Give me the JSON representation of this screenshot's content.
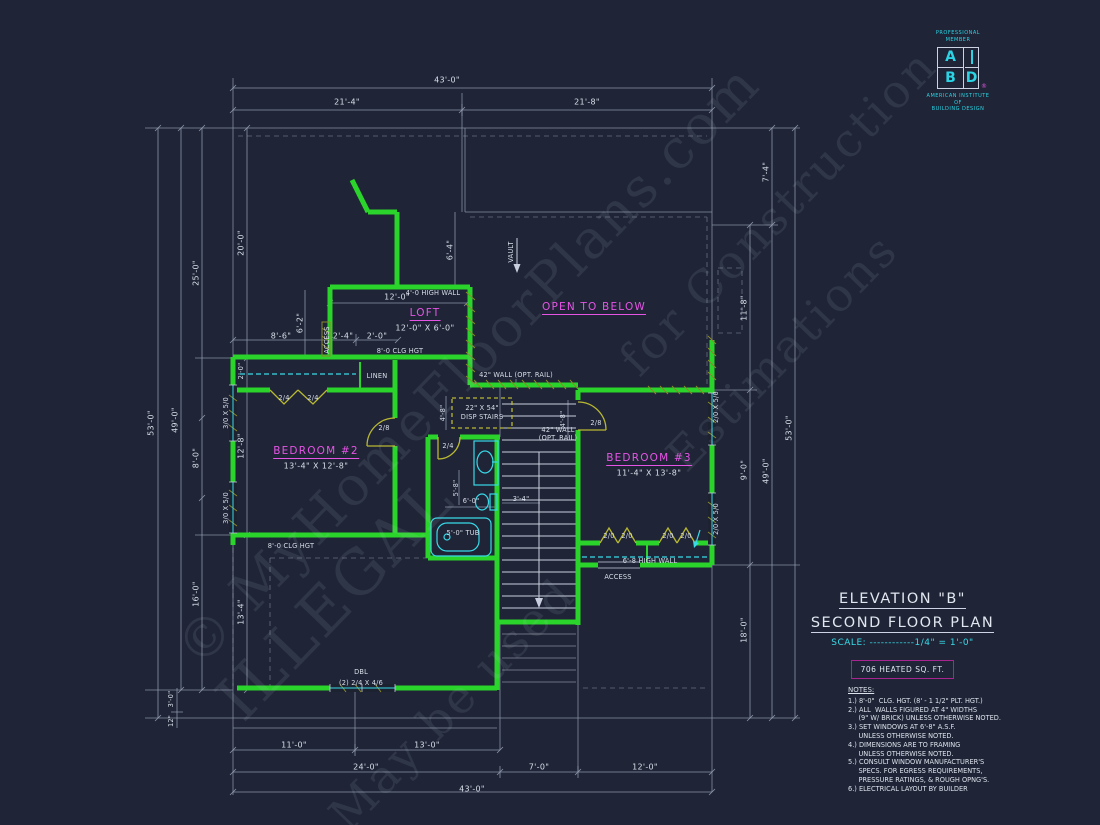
{
  "colors": {
    "background": "#1f2536",
    "wall_green": "#2bd42b",
    "fixture_cyan": "#38d9e8",
    "label_magenta": "#e654e6",
    "door_olive": "#b9b832",
    "line_gray": "#97a0b6",
    "heated_box_border": "#a8258f",
    "logo_cyan": "#2bd3e4"
  },
  "title_block": {
    "line1": "ELEVATION \"B\"",
    "line2": "SECOND FLOOR PLAN",
    "scale": "SCALE: ------------1/4\" = 1'-0\"",
    "heated": "706 HEATED SQ. FT."
  },
  "logo": {
    "top1": "PROFESSIONAL",
    "top2": "MEMBER",
    "a": "A",
    "b": "B",
    "d": "D",
    "reg": "®",
    "org1": "AMERICAN INSTITUTE",
    "org2": "OF",
    "org3": "BUILDING DESIGN"
  },
  "notes": {
    "lines": [
      "NOTES:",
      "1.) 8'-0\"  CLG. HGT. (8' - 1 1/2\" PLT. HGT.)",
      "2.) ALL  WALLS FIGURED AT 4\" WIDTHS",
      "     (9\" W/ BRICK) UNLESS OTHERWISE NOTED.",
      "3.) SET WINDOWS AT 6'-8\" A.S.F.",
      "     UNLESS OTHERWISE NOTED.",
      "4.) DIMENSIONS ARE TO FRAMING",
      "     UNLESS OTHERWISE NOTED.",
      "5.) CONSULT WINDOW MANUFACTURER'S",
      "     SPECS. FOR EGRESS REQUIREMENTS,",
      "     PRESSURE RATINGS, & ROUGH OPNG'S.",
      "6.) ELECTRICAL LAYOUT BY BUILDER"
    ]
  },
  "watermarks": [
    {
      "t": "© MyHomeFloorPlans.com",
      "x": 468,
      "y": 365,
      "size": 54,
      "n": "watermark-site"
    },
    {
      "t": "ILLEGAL",
      "x": 335,
      "y": 598,
      "size": 62,
      "n": "watermark-illegal"
    },
    {
      "t": "for Construction",
      "x": 778,
      "y": 212,
      "size": 46,
      "n": "watermark-construction"
    },
    {
      "t": "May be used",
      "x": 452,
      "y": 704,
      "size": 46,
      "n": "watermark-may-be-used"
    },
    {
      "t": "Estimations",
      "x": 782,
      "y": 352,
      "size": 46,
      "n": "watermark-estimations"
    }
  ],
  "plan": {
    "labels": [
      {
        "t": "43'-0\"",
        "x": 447,
        "y": 80,
        "r": 0,
        "s": "dim"
      },
      {
        "t": "21'-4\"",
        "x": 347,
        "y": 102,
        "r": 0,
        "s": "dim"
      },
      {
        "t": "21'-8\"",
        "x": 587,
        "y": 102,
        "r": 0,
        "s": "dim"
      },
      {
        "t": "11'-0\"",
        "x": 294,
        "y": 745,
        "r": 0,
        "s": "dim"
      },
      {
        "t": "13'-0\"",
        "x": 427,
        "y": 745,
        "r": 0,
        "s": "dim"
      },
      {
        "t": "24'-0\"",
        "x": 366,
        "y": 767,
        "r": 0,
        "s": "dim"
      },
      {
        "t": "7'-0\"",
        "x": 539,
        "y": 767,
        "r": 0,
        "s": "dim"
      },
      {
        "t": "12'-0\"",
        "x": 645,
        "y": 767,
        "r": 0,
        "s": "dim"
      },
      {
        "t": "43'-0\"",
        "x": 472,
        "y": 789,
        "r": 0,
        "s": "dim"
      },
      {
        "t": "53'-0\"",
        "x": 151,
        "y": 423,
        "r": -90,
        "s": "dim"
      },
      {
        "t": "49'-0\"",
        "x": 175,
        "y": 420,
        "r": -90,
        "s": "dim"
      },
      {
        "t": "25'-0\"",
        "x": 196,
        "y": 273,
        "r": -90,
        "s": "dim"
      },
      {
        "t": "8'-0\"",
        "x": 196,
        "y": 458,
        "r": -90,
        "s": "dim"
      },
      {
        "t": "16'-0\"",
        "x": 196,
        "y": 594,
        "r": -90,
        "s": "dim"
      },
      {
        "t": "20'-0\"",
        "x": 241,
        "y": 243,
        "r": -90,
        "s": "dim"
      },
      {
        "t": "12'-8\"",
        "x": 241,
        "y": 446,
        "r": -90,
        "s": "dim"
      },
      {
        "t": "13'-4\"",
        "x": 241,
        "y": 612,
        "r": -90,
        "s": "dim"
      },
      {
        "t": "3'-0\"",
        "x": 171,
        "y": 699,
        "r": -90,
        "s": "tiny"
      },
      {
        "t": "12\"",
        "x": 171,
        "y": 721,
        "r": -90,
        "s": "tiny"
      },
      {
        "t": "7'-4\"",
        "x": 766,
        "y": 172,
        "r": -90,
        "s": "dim"
      },
      {
        "t": "11'-8\"",
        "x": 744,
        "y": 308,
        "r": -90,
        "s": "dim"
      },
      {
        "t": "9'-0\"",
        "x": 744,
        "y": 470,
        "r": -90,
        "s": "dim"
      },
      {
        "t": "18'-0\"",
        "x": 744,
        "y": 630,
        "r": -90,
        "s": "dim"
      },
      {
        "t": "49'-0\"",
        "x": 766,
        "y": 471,
        "r": -90,
        "s": "dim"
      },
      {
        "t": "53'-0\"",
        "x": 789,
        "y": 428,
        "r": -90,
        "s": "dim"
      },
      {
        "t": "6'-4\"",
        "x": 450,
        "y": 250,
        "r": -90,
        "s": "dim"
      },
      {
        "t": "VAULT",
        "x": 511,
        "y": 252,
        "r": -90,
        "s": "tiny",
        "n": "vault-label"
      },
      {
        "t": "4'-0 HIGH WALL",
        "x": 433,
        "y": 293,
        "r": 0,
        "s": "tiny",
        "n": "high-wall-label"
      },
      {
        "t": "12'-0\"",
        "x": 397,
        "y": 297,
        "r": 0,
        "s": "dim"
      },
      {
        "t": "LOFT",
        "x": 425,
        "y": 314,
        "r": 0,
        "s": "room",
        "n": "loft-label"
      },
      {
        "t": "12'-0\" X 6'-0\"",
        "x": 425,
        "y": 328,
        "r": 0,
        "s": "roomsub"
      },
      {
        "t": "OPEN TO BELOW",
        "x": 594,
        "y": 308,
        "r": 0,
        "s": "room",
        "n": "open-to-below-label"
      },
      {
        "t": "6'-2\"",
        "x": 300,
        "y": 323,
        "r": -90,
        "s": "dim"
      },
      {
        "t": "8'-6\"",
        "x": 281,
        "y": 336,
        "r": 0,
        "s": "dim"
      },
      {
        "t": "2'-4\"",
        "x": 343,
        "y": 336,
        "r": 0,
        "s": "dim"
      },
      {
        "t": "2'-0\"",
        "x": 377,
        "y": 336,
        "r": 0,
        "s": "dim"
      },
      {
        "t": "ACCESS",
        "x": 327,
        "y": 340,
        "r": -90,
        "s": "tiny",
        "n": "access-label"
      },
      {
        "t": "8'-0 CLG HGT",
        "x": 400,
        "y": 351,
        "r": 0,
        "s": "tiny",
        "n": "clg-hgt-label"
      },
      {
        "t": "LINEN",
        "x": 377,
        "y": 376,
        "r": 0,
        "s": "tiny",
        "n": "linen-label"
      },
      {
        "t": "2/4",
        "x": 284,
        "y": 398,
        "r": 0,
        "s": "tiny"
      },
      {
        "t": "2/4",
        "x": 313,
        "y": 398,
        "r": 0,
        "s": "tiny"
      },
      {
        "t": "2'-0\"",
        "x": 241,
        "y": 371,
        "r": -90,
        "s": "tiny"
      },
      {
        "t": "3/0 X 5/0",
        "x": 226,
        "y": 413,
        "r": -90,
        "s": "tiny",
        "n": "window-label"
      },
      {
        "t": "3/0 X 5/0",
        "x": 226,
        "y": 508,
        "r": -90,
        "s": "tiny",
        "n": "window-label"
      },
      {
        "t": "BEDROOM #2",
        "x": 316,
        "y": 452,
        "r": 0,
        "s": "room",
        "n": "bedroom2-label"
      },
      {
        "t": "13'-4\" X 12'-8\"",
        "x": 316,
        "y": 466,
        "r": 0,
        "s": "roomsub"
      },
      {
        "t": "BEDROOM #3",
        "x": 649,
        "y": 459,
        "r": 0,
        "s": "room",
        "n": "bedroom3-label"
      },
      {
        "t": "11'-4\" X 13'-8\"",
        "x": 649,
        "y": 473,
        "r": 0,
        "s": "roomsub"
      },
      {
        "t": "42\" WALL (OPT. RAIL)",
        "x": 516,
        "y": 375,
        "r": 0,
        "s": "tiny",
        "n": "rail-wall-label"
      },
      {
        "t": "22\" X 54\"",
        "x": 482,
        "y": 408,
        "r": 0,
        "s": "tiny"
      },
      {
        "t": "DISP STAIRS",
        "x": 482,
        "y": 417,
        "r": 0,
        "s": "tiny",
        "n": "disp-stairs-label"
      },
      {
        "t": "4'-8\"",
        "x": 443,
        "y": 413,
        "r": -90,
        "s": "tiny"
      },
      {
        "t": "4'-8\"",
        "x": 563,
        "y": 419,
        "r": -90,
        "s": "tiny"
      },
      {
        "t": "2/4",
        "x": 448,
        "y": 446,
        "r": 0,
        "s": "tiny"
      },
      {
        "t": "5'-8\"",
        "x": 456,
        "y": 488,
        "r": -90,
        "s": "tiny"
      },
      {
        "t": "6'-0\"",
        "x": 471,
        "y": 501,
        "r": 0,
        "s": "tiny"
      },
      {
        "t": "5'-0\" TUB",
        "x": 463,
        "y": 533,
        "r": 0,
        "s": "tiny",
        "n": "tub-label"
      },
      {
        "t": "3'-4\"",
        "x": 521,
        "y": 499,
        "r": 0,
        "s": "tiny"
      },
      {
        "t": "42\" WALL",
        "x": 558,
        "y": 430,
        "r": 0,
        "s": "tiny"
      },
      {
        "t": "(OPT. RAIL)",
        "x": 558,
        "y": 438,
        "r": 0,
        "s": "tiny"
      },
      {
        "t": "2/8",
        "x": 384,
        "y": 428,
        "r": 0,
        "s": "tiny"
      },
      {
        "t": "2/8",
        "x": 596,
        "y": 423,
        "r": 0,
        "s": "tiny"
      },
      {
        "t": "2/0",
        "x": 609,
        "y": 536,
        "r": 0,
        "s": "tiny"
      },
      {
        "t": "2/0",
        "x": 627,
        "y": 536,
        "r": 0,
        "s": "tiny"
      },
      {
        "t": "2/0",
        "x": 668,
        "y": 536,
        "r": 0,
        "s": "tiny"
      },
      {
        "t": "2/0",
        "x": 686,
        "y": 536,
        "r": 0,
        "s": "tiny"
      },
      {
        "t": "6'-8 HIGH WALL",
        "x": 650,
        "y": 561,
        "r": 0,
        "s": "tiny",
        "n": "high-wall-label-2"
      },
      {
        "t": "ACCESS",
        "x": 618,
        "y": 577,
        "r": 0,
        "s": "tiny",
        "n": "access-label-2"
      },
      {
        "t": "2/0 X 5/0",
        "x": 716,
        "y": 407,
        "r": -90,
        "s": "tiny",
        "n": "window-label"
      },
      {
        "t": "2/0 X 5/0",
        "x": 716,
        "y": 519,
        "r": -90,
        "s": "tiny",
        "n": "window-label"
      },
      {
        "t": "8'-0 CLG HGT",
        "x": 291,
        "y": 546,
        "r": 0,
        "s": "tiny",
        "n": "clg-hgt-label-2"
      },
      {
        "t": "DBL",
        "x": 361,
        "y": 672,
        "r": 0,
        "s": "tiny"
      },
      {
        "t": "(2) 2/4 X 4/6",
        "x": 361,
        "y": 683,
        "r": 0,
        "s": "tiny",
        "n": "dbl-window-label"
      }
    ]
  }
}
